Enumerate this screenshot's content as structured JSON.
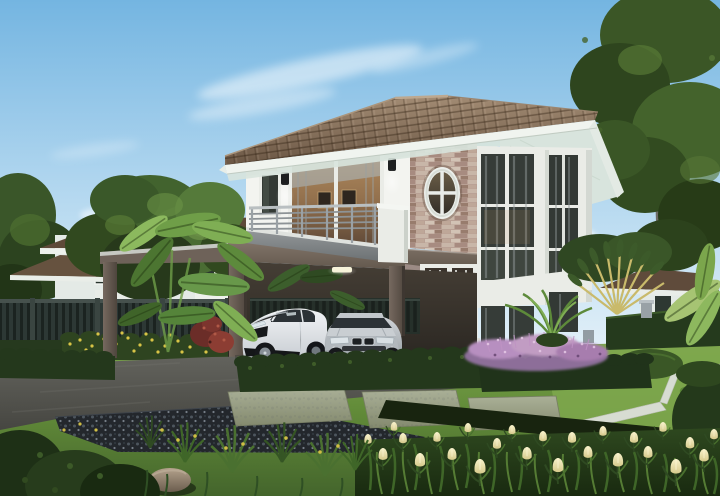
{
  "scene": {
    "type": "exterior-architectural-rendering",
    "time_of_day": "day",
    "sky": "clear blue sky with wispy clouds",
    "main_house": {
      "stories": 2,
      "roof": "brown hip tile roof with white fascia",
      "walls": "white upper storey, taupe ground floor",
      "features": [
        "stacked-stone accent wall",
        "oval window with cross muntin",
        "balcony with metal railing",
        "sliding glass door",
        "two-storey corner bay window",
        "carport on columns",
        "french entrance doors",
        "wall sconce lamps",
        "carport ceiling light"
      ]
    },
    "vehicles": [
      "white sports coupe",
      "silver sedan"
    ],
    "garden": [
      "manicured lawn",
      "boxwood hedges",
      "yellow flower border",
      "purple fountain-grass bed",
      "white tulip bed",
      "banana plants",
      "travellers palm fan",
      "stone pavers",
      "black pebble strip",
      "asphalt driveway",
      "white lawn edging",
      "garden rock"
    ],
    "background": [
      "neighbouring two-storey house",
      "neighbouring house roof",
      "dark slat fence",
      "large shade trees"
    ]
  },
  "palette": {
    "sky_top": "#74b5e1",
    "sky_mid": "#b6d9f0",
    "sky_horizon": "#e6f2f9",
    "cloud": "#ffffff",
    "roof_tile": "#8a745e",
    "roof_tile_dark": "#6a5644",
    "roof_ridge": "#b7a089",
    "fascia": "#f0f4ef",
    "soffit": "#d8e4dd",
    "wall_white": "#f3f4f0",
    "stone": "#c6afa2",
    "slab": "#7b6e64",
    "column": "#6c6159",
    "lower_wall": "#9c8b85",
    "glass_dark": "#363c38",
    "curtain": "#9aa0a0",
    "interior_warm": "#96764f",
    "white_frame": "#eaece7",
    "rail_metal": "#9aa1a5",
    "car_white": "#e7eaec",
    "car_silver": "#b9bec2",
    "car_glass": "#2c3236",
    "lawn_light": "#7aa24a",
    "lawn_dark": "#44652c",
    "hedge": "#24381c",
    "hedge_dark": "#18240f",
    "foliage_light": "#618540",
    "foliage_dark": "#2c421f",
    "banana_leaf": "#6f9e48",
    "asphalt": "#5e5e58",
    "curb": "#909188",
    "gravel": "#23272c",
    "paver": "#9ea389",
    "edging_white": "#d7dcd2",
    "tulip_cream": "#efe8b8",
    "flower_purple": "#c19cc3",
    "flower_yellow": "#d8c446",
    "red_foliage": "#7c352e",
    "fence_dark": "#232b29",
    "bg_roof": "#5e4a39",
    "bg_wall": "#e4eae6",
    "palm_gold": "#c9ba6b",
    "trunk": "#55412e",
    "rock": "#9b8a76"
  }
}
